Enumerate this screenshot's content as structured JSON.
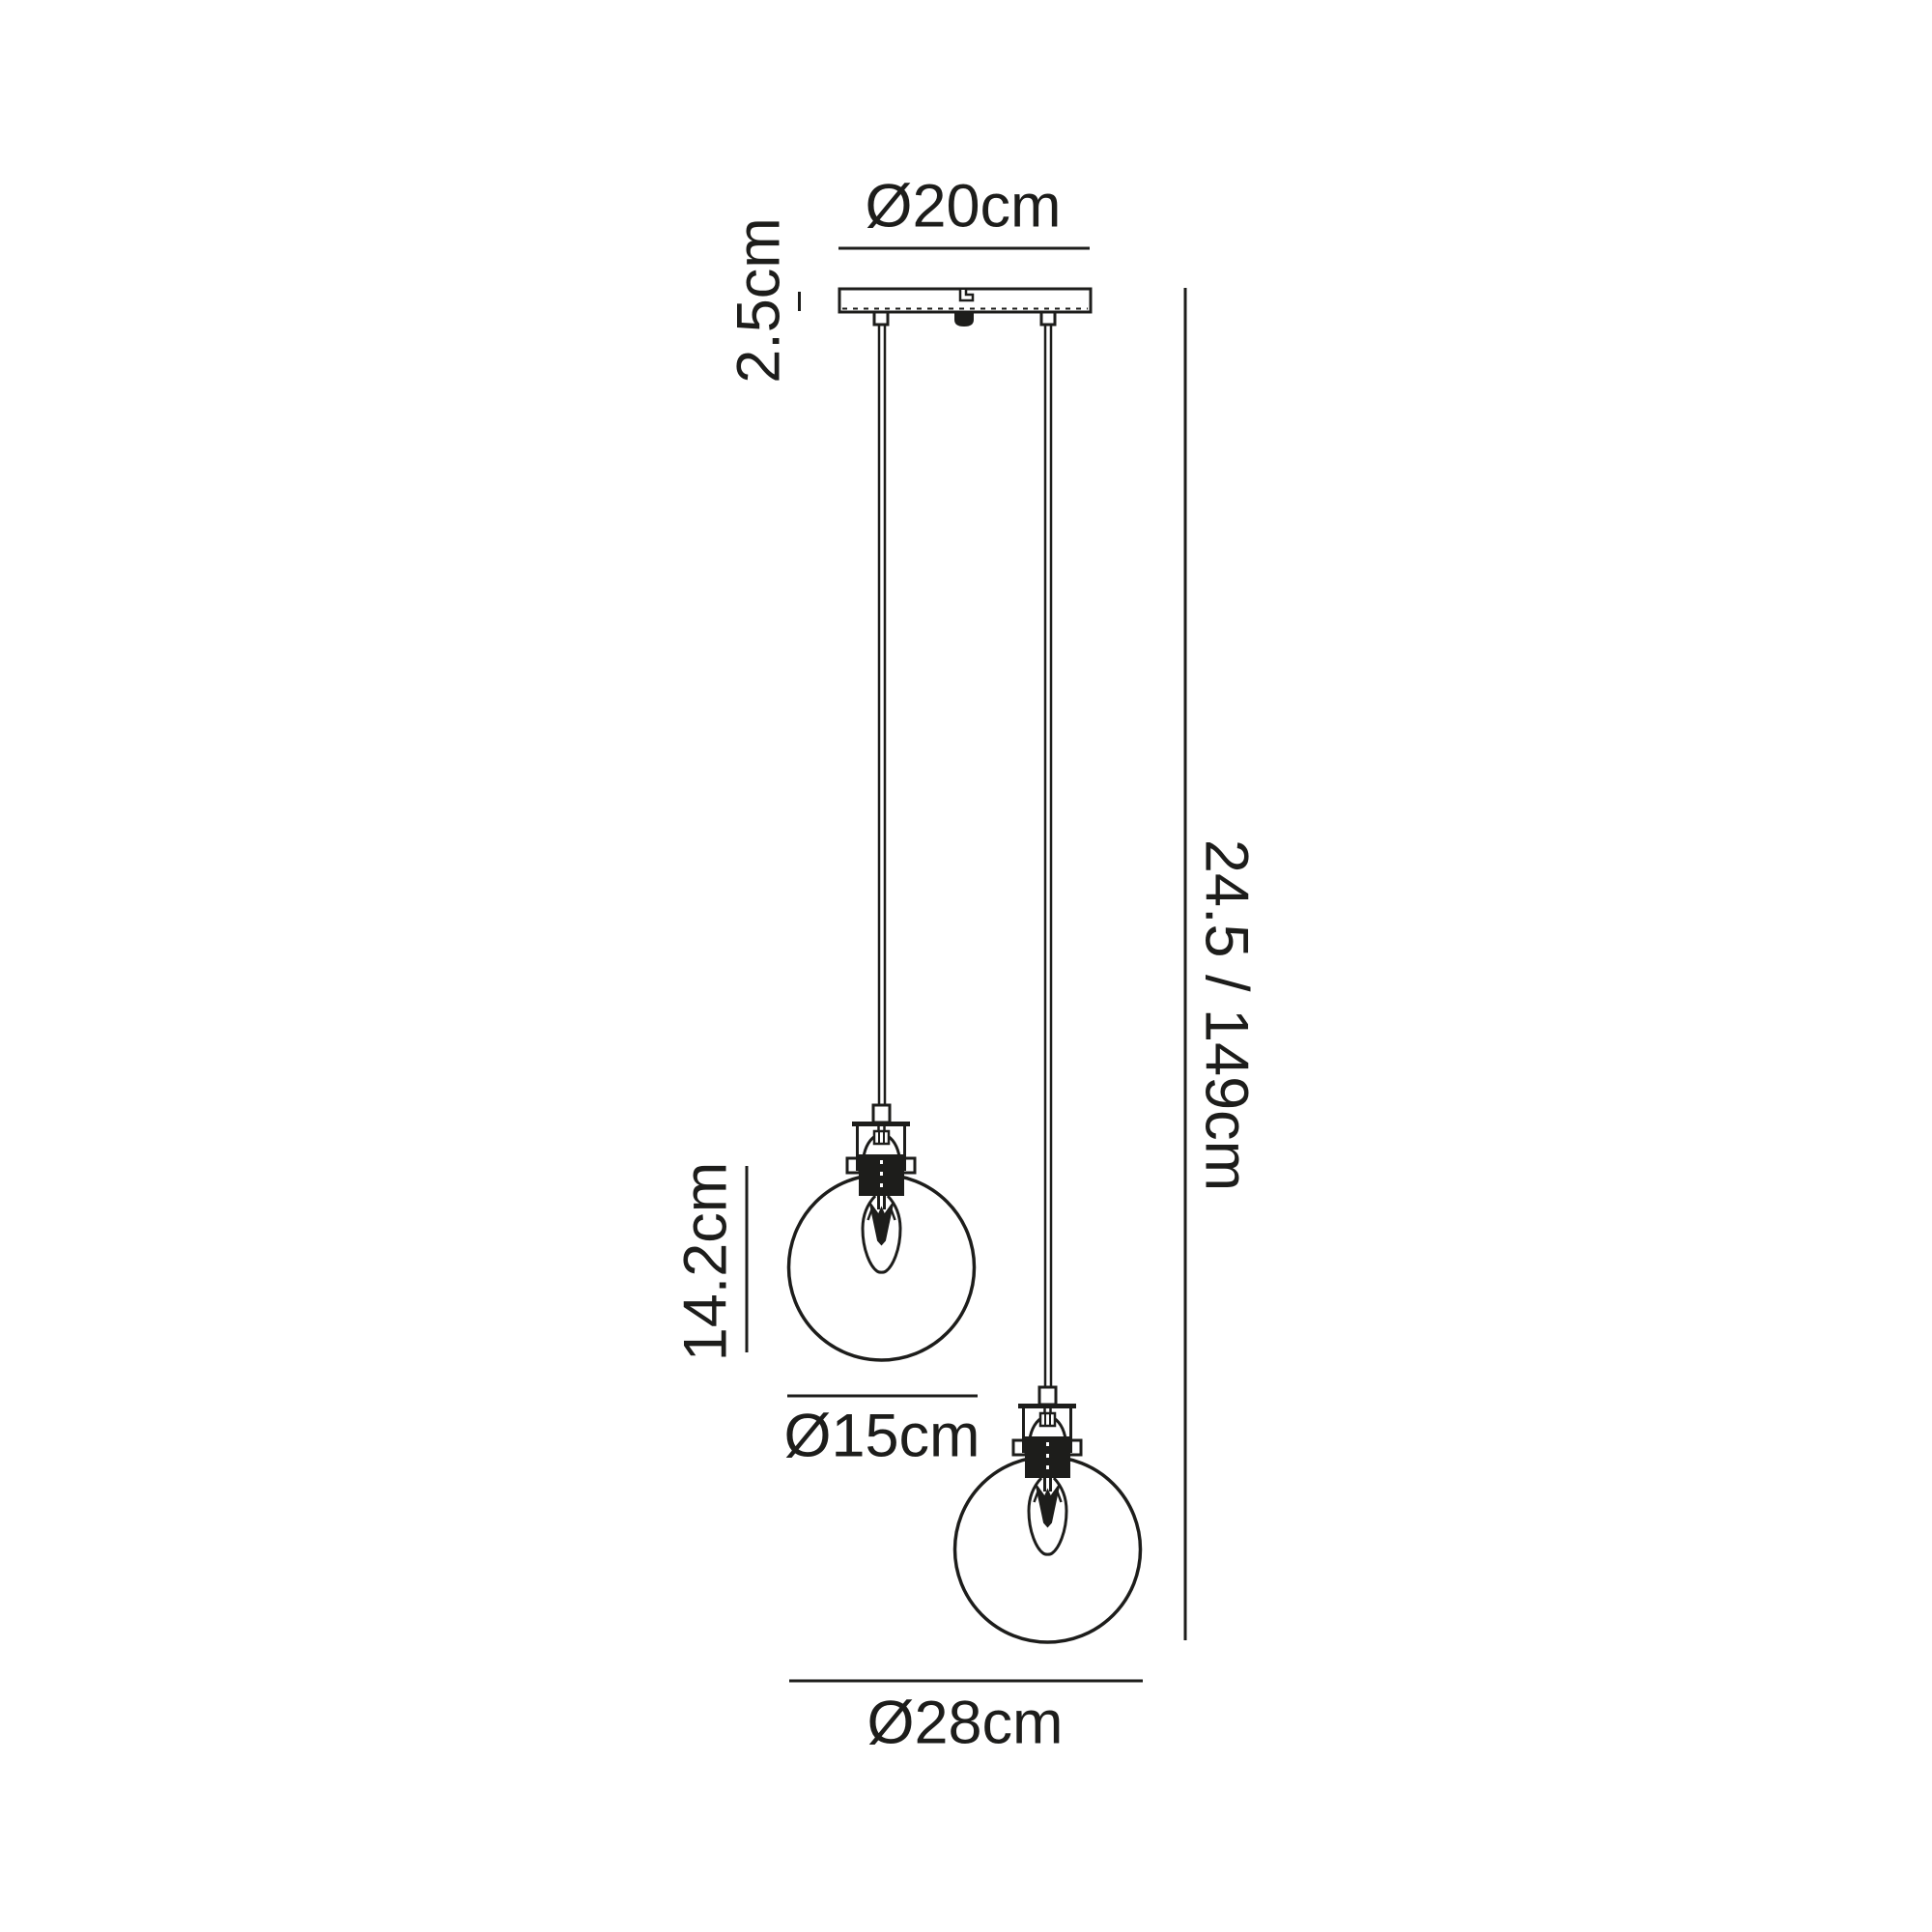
{
  "diagram": {
    "title": "pendant-light-dimension-drawing",
    "colors": {
      "line": "#1d1d1b",
      "background": "#ffffff"
    },
    "labels": {
      "canopy_diameter": "Ø20cm",
      "canopy_height": "2.5cm",
      "small_globe_height": "14.2cm",
      "small_globe_diameter": "Ø15cm",
      "overall_drop": "24.5 / 149cm",
      "large_globe_diameter": "Ø28cm"
    }
  }
}
